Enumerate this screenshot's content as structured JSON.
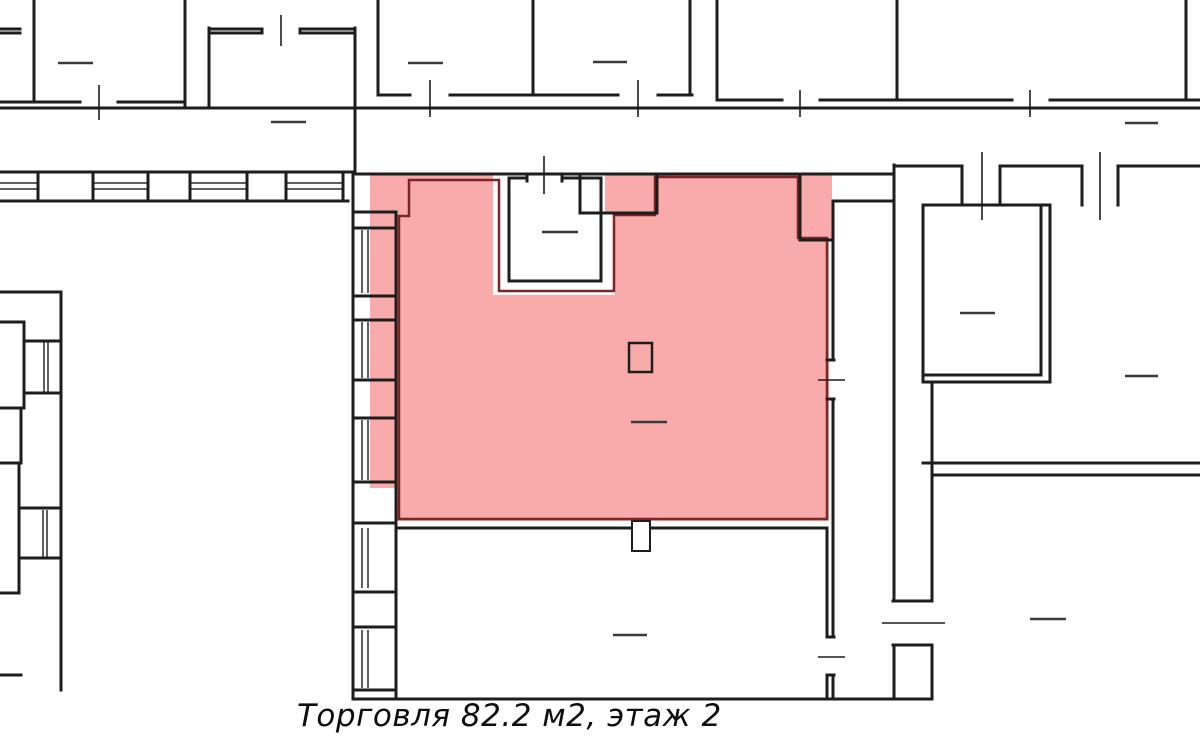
{
  "caption": {
    "text": "Торговля 82.2 м2, этаж 2",
    "usage": "Торговля",
    "area": "82.2 м2",
    "floor": "2"
  },
  "colors": {
    "background": "#ffffff",
    "walls": "#1d1d1d",
    "furniture_marks": "#3a3a3a",
    "door_marks": "#1d1d1d",
    "window_glazing": "#2a2a2a",
    "highlight_fill": "#f9abab",
    "highlight_outline": "#7d2424",
    "caption_text": "#0d0d0d"
  }
}
